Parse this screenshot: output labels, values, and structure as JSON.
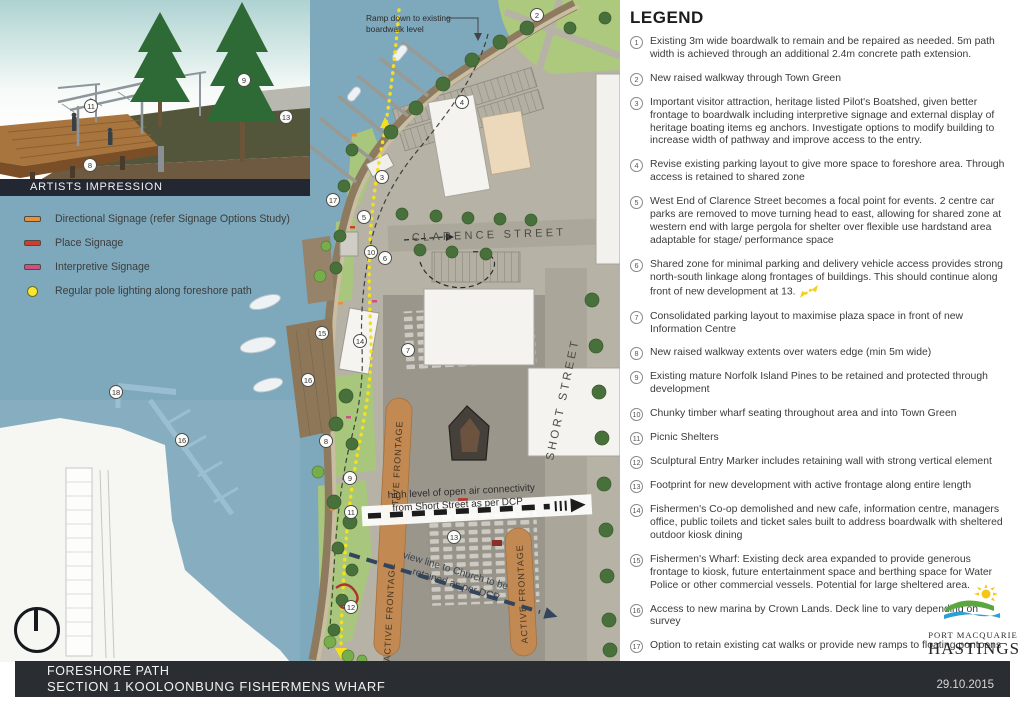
{
  "legend": {
    "title": "LEGEND",
    "items": [
      {
        "num": "1",
        "text": "Existing 3m wide boardwalk to remain and be repaired as needed. 5m path width is achieved through an additional 2.4m concrete path extension."
      },
      {
        "num": "2",
        "text": "New raised walkway through Town Green"
      },
      {
        "num": "3",
        "text": "Important visitor attraction, heritage listed Pilot's Boatshed, given better frontage to boardwalk including interpretive signage and external display of heritage boating items eg anchors. Investigate options to modify building to increase width of pathway and improve access to the entry."
      },
      {
        "num": "4",
        "text": "Revise existing parking layout to give more space to foreshore area. Through access is retained to shared zone"
      },
      {
        "num": "5",
        "text": "West End of Clarence Street becomes a focal point for events. 2 centre car parks are removed to move turning head to east, allowing for shared zone at western end with large pergola for shelter over flexible use hardstand area adaptable for stage/ performance space"
      },
      {
        "num": "6",
        "text": "Shared zone for minimal parking and delivery vehicle access provides strong north-south linkage along frontages of buildings. This should continue along front of new development at 13.",
        "has_arrow": true
      },
      {
        "num": "7",
        "text": "Consolidated parking layout to maximise plaza space in front of new Information Centre"
      },
      {
        "num": "8",
        "text": "New raised walkway extents over waters edge (min 5m wide)"
      },
      {
        "num": "9",
        "text": "Existing mature Norfolk Island Pines to be retained and protected through development"
      },
      {
        "num": "10",
        "text": "Chunky timber wharf seating throughout area and into Town Green"
      },
      {
        "num": "11",
        "text": "Picnic Shelters"
      },
      {
        "num": "12",
        "text": "Sculptural Entry Marker includes retaining wall with strong vertical element"
      },
      {
        "num": "13",
        "text": "Footprint for new development with active frontage along entire length"
      },
      {
        "num": "14",
        "text": "Fishermen's Co-op demolished and new cafe, information centre, managers office, public toilets and ticket sales built to address boardwalk with sheltered outdoor kiosk dining"
      },
      {
        "num": "15",
        "text": "Fishermen's Wharf: Existing deck area expanded to provide generous frontage to kiosk, future entertainment space and berthing space for Water Police or other commercial vessels. Potential for large sheltered area."
      },
      {
        "num": "16",
        "text": "Access to new marina by Crown Lands. Deck line to vary depending on survey"
      },
      {
        "num": "17",
        "text": "Option to retain existing cat walks or provide new ramps to floating pontoons"
      },
      {
        "num": "18",
        "text": "Existing western jetty provides option for relocating refuelling and other commercial uses incompatible with public access"
      }
    ]
  },
  "signage_legend": {
    "items": [
      {
        "label": "Directional Signage (refer Signage Options Study)",
        "color": "#e8913a",
        "shape": "dash"
      },
      {
        "label": "Place Signage",
        "color": "#d23b2f",
        "shape": "dash"
      },
      {
        "label": "Interpretive Signage",
        "color": "#cc4f86",
        "shape": "dash"
      },
      {
        "label": "Regular pole lighting along foreshore path",
        "color": "#f7e733",
        "shape": "dot"
      }
    ]
  },
  "map": {
    "labels": {
      "ramp_note_line1": "Ramp down to existing",
      "ramp_note_line2": "boardwalk level",
      "clarence_street": "CLARENCE STREET",
      "short_street": "SHORT STREET",
      "active_frontage": "ACTIVE FRONTAGE",
      "open_air_line1": "high level of open air connectivity",
      "open_air_line2": "from Short Street as per DCP",
      "view_line_line1": "view line to Church to be",
      "view_line_line2": "retained as per DCP"
    },
    "markers": [
      {
        "n": "1",
        "x": 243,
        "y": 80
      },
      {
        "n": "2",
        "x": 537,
        "y": 15
      },
      {
        "n": "3",
        "x": 382,
        "y": 177
      },
      {
        "n": "4",
        "x": 462,
        "y": 102
      },
      {
        "n": "5",
        "x": 364,
        "y": 217
      },
      {
        "n": "6",
        "x": 385,
        "y": 258
      },
      {
        "n": "7",
        "x": 408,
        "y": 350
      },
      {
        "n": "8",
        "x": 326,
        "y": 441
      },
      {
        "n": "9",
        "x": 350,
        "y": 478
      },
      {
        "n": "10",
        "x": 371,
        "y": 252
      },
      {
        "n": "11",
        "x": 351,
        "y": 512
      },
      {
        "n": "12",
        "x": 351,
        "y": 607
      },
      {
        "n": "13",
        "x": 454,
        "y": 537
      },
      {
        "n": "14",
        "x": 360,
        "y": 341
      },
      {
        "n": "15",
        "x": 322,
        "y": 333
      },
      {
        "n": "16",
        "x": 308,
        "y": 380
      },
      {
        "n": "16",
        "x": 182,
        "y": 440
      },
      {
        "n": "17",
        "x": 333,
        "y": 200
      },
      {
        "n": "18",
        "x": 116,
        "y": 392
      }
    ],
    "inset": {
      "caption": "ARTISTS IMPRESSION",
      "markers": [
        {
          "n": "11",
          "x": 91,
          "y": 106
        },
        {
          "n": "9",
          "x": 244,
          "y": 80
        },
        {
          "n": "13",
          "x": 286,
          "y": 117
        },
        {
          "n": "8",
          "x": 90,
          "y": 165
        }
      ]
    }
  },
  "footer": {
    "title_line1": "FORESHORE PATH",
    "title_line2": "SECTION 1 KOOLOONBUNG FISHERMENS WHARF",
    "date": "29.10.2015"
  },
  "logo": {
    "line1": "PORT MACQUARIE",
    "line2": "HASTINGS"
  },
  "colors": {
    "water": "#7ea8bb",
    "paving": "#b6b2a5",
    "green": "#aecb7f",
    "path_yellow": "#f4e01d",
    "active_frontage": "#c28a52",
    "footer_bar": "#2a2d31"
  }
}
